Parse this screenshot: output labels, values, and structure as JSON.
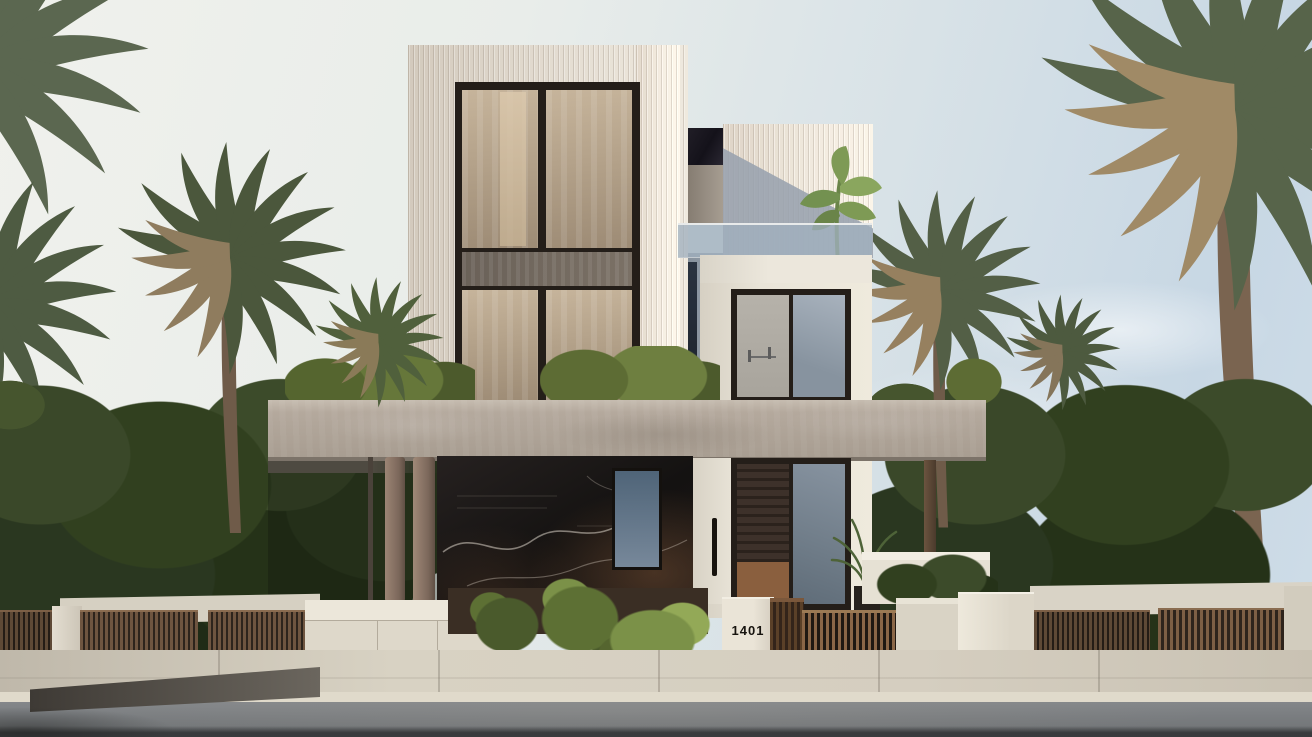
{
  "image_type": "photorealistic architectural exterior rendering",
  "scene": {
    "subject": "modern three-storey villa with fluted cream facade, dark marble base, concrete canopy, wooden gates, street and palm trees",
    "house_number": "1401",
    "time_of_day": "day"
  },
  "palette": {
    "sky_left": "#f0f1ec",
    "sky_right": "#c7d7e4",
    "facade_fluted_cream": "#e4ddd2",
    "window_frame_bronze": "#241e19",
    "window_glass_tan": "#b4a28a",
    "shadow_wall_blue_gray": "#8f99a3",
    "balcony_glass": "#a0b0be",
    "concrete_canopy": "#b4a99d",
    "marble_black": "#1b1715",
    "marble_vein": "#d8d2c6",
    "marble_brown": "#6e4a30",
    "column_concrete": "#8d7465",
    "wood_fence": "#6e5540",
    "wood_gate": "#8a6647",
    "white_pillar": "#e5dfd2",
    "foliage_dark": "#2a3720",
    "foliage_bright": "#7b9148",
    "palm_green": "#4b573c",
    "palm_dried": "#96805f",
    "sidewalk": "#d5cec0",
    "road_asphalt": "#7a7d80"
  }
}
